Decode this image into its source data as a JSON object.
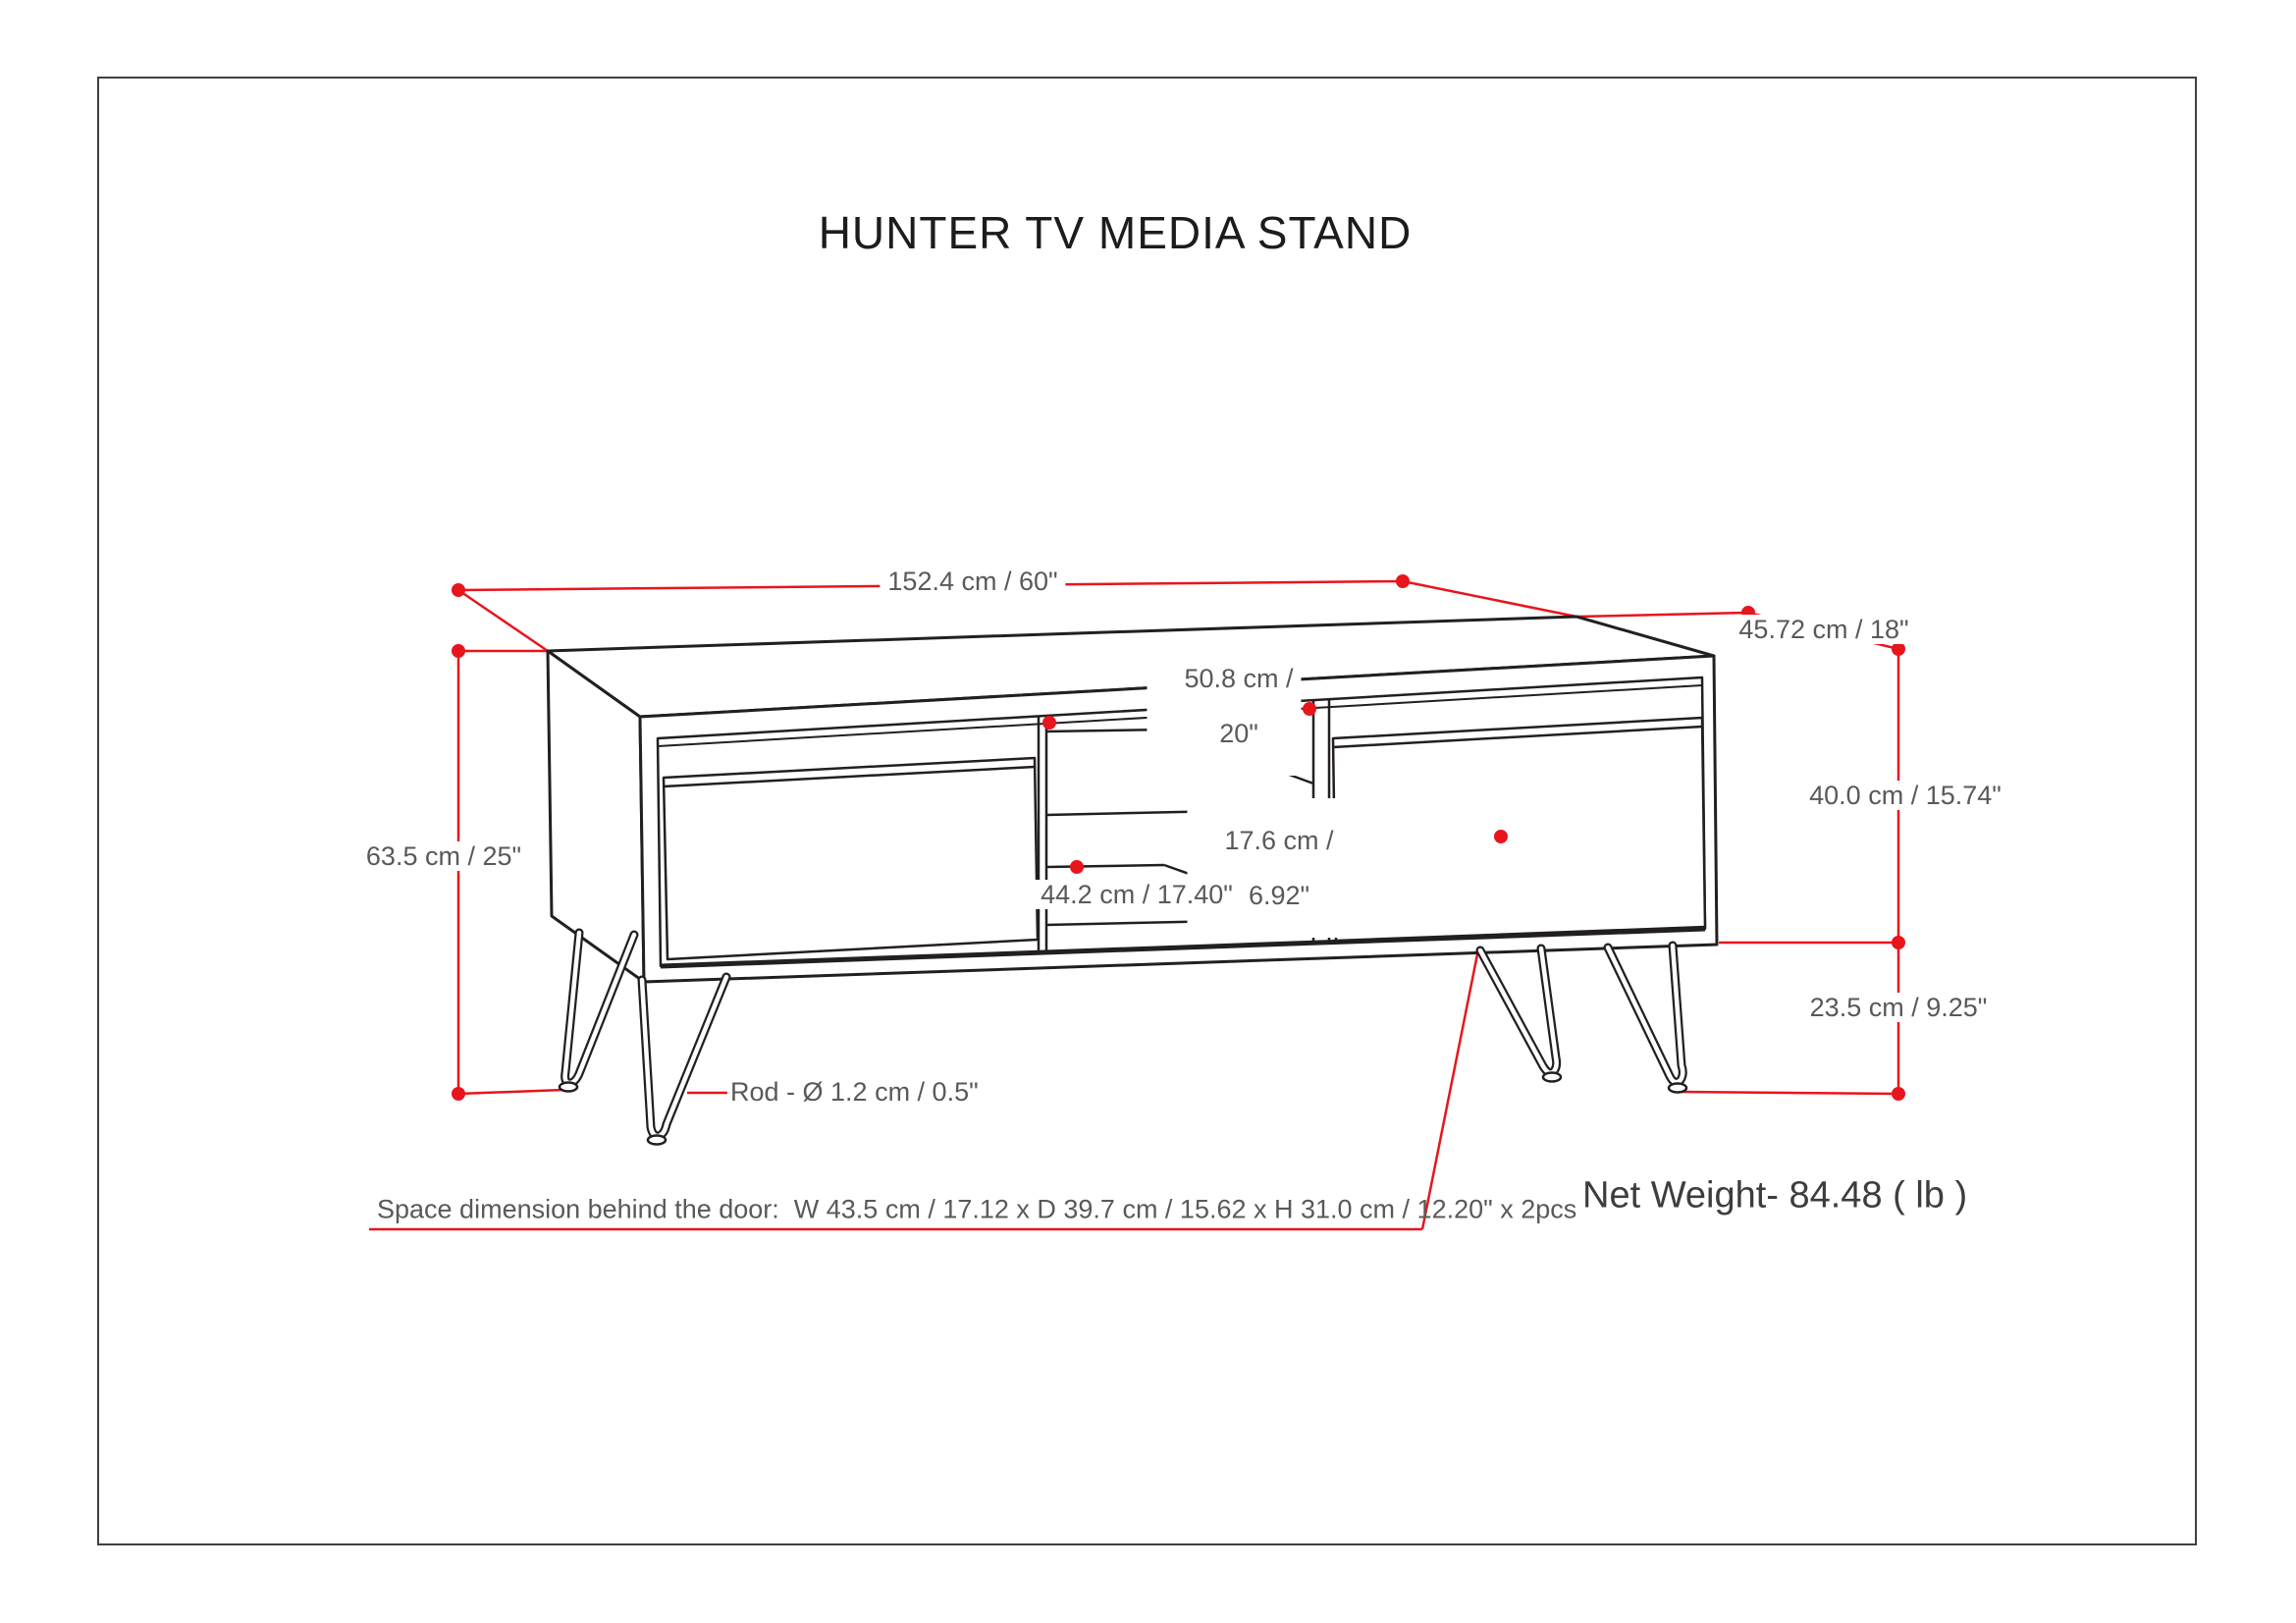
{
  "title": "HUNTER TV MEDIA STAND",
  "drawing": {
    "dimensions": {
      "overall_width": "152.4 cm / 60\"",
      "overall_depth": "45.72 cm / 18\"",
      "overall_height": "63.5 cm / 25\"",
      "cabinet_height": "40.0 cm / 15.74\"",
      "leg_height": "23.5 cm / 9.25\"",
      "opening_width_line1": "50.8 cm /",
      "opening_width_line2": "20\"",
      "shelf_opening_height_line1": "17.6 cm /",
      "shelf_opening_height_line2": "6.92\"",
      "shelf_depth": "44.2 cm / 17.40\"",
      "leg_rod": "Rod - Ø 1.2 cm / 0.5\""
    },
    "footnote": "Space dimension behind the door:  W 43.5 cm / 17.12 x D 39.7 cm / 15.62 x H 31.0 cm / 12.20\" x 2pcs",
    "net_weight": "Net Weight- 84.48 ( lb )"
  },
  "colors": {
    "dimension_red": "#e8151d",
    "line_ink": "#231f20",
    "label_gray": "#595959",
    "border_gray": "#404040"
  }
}
